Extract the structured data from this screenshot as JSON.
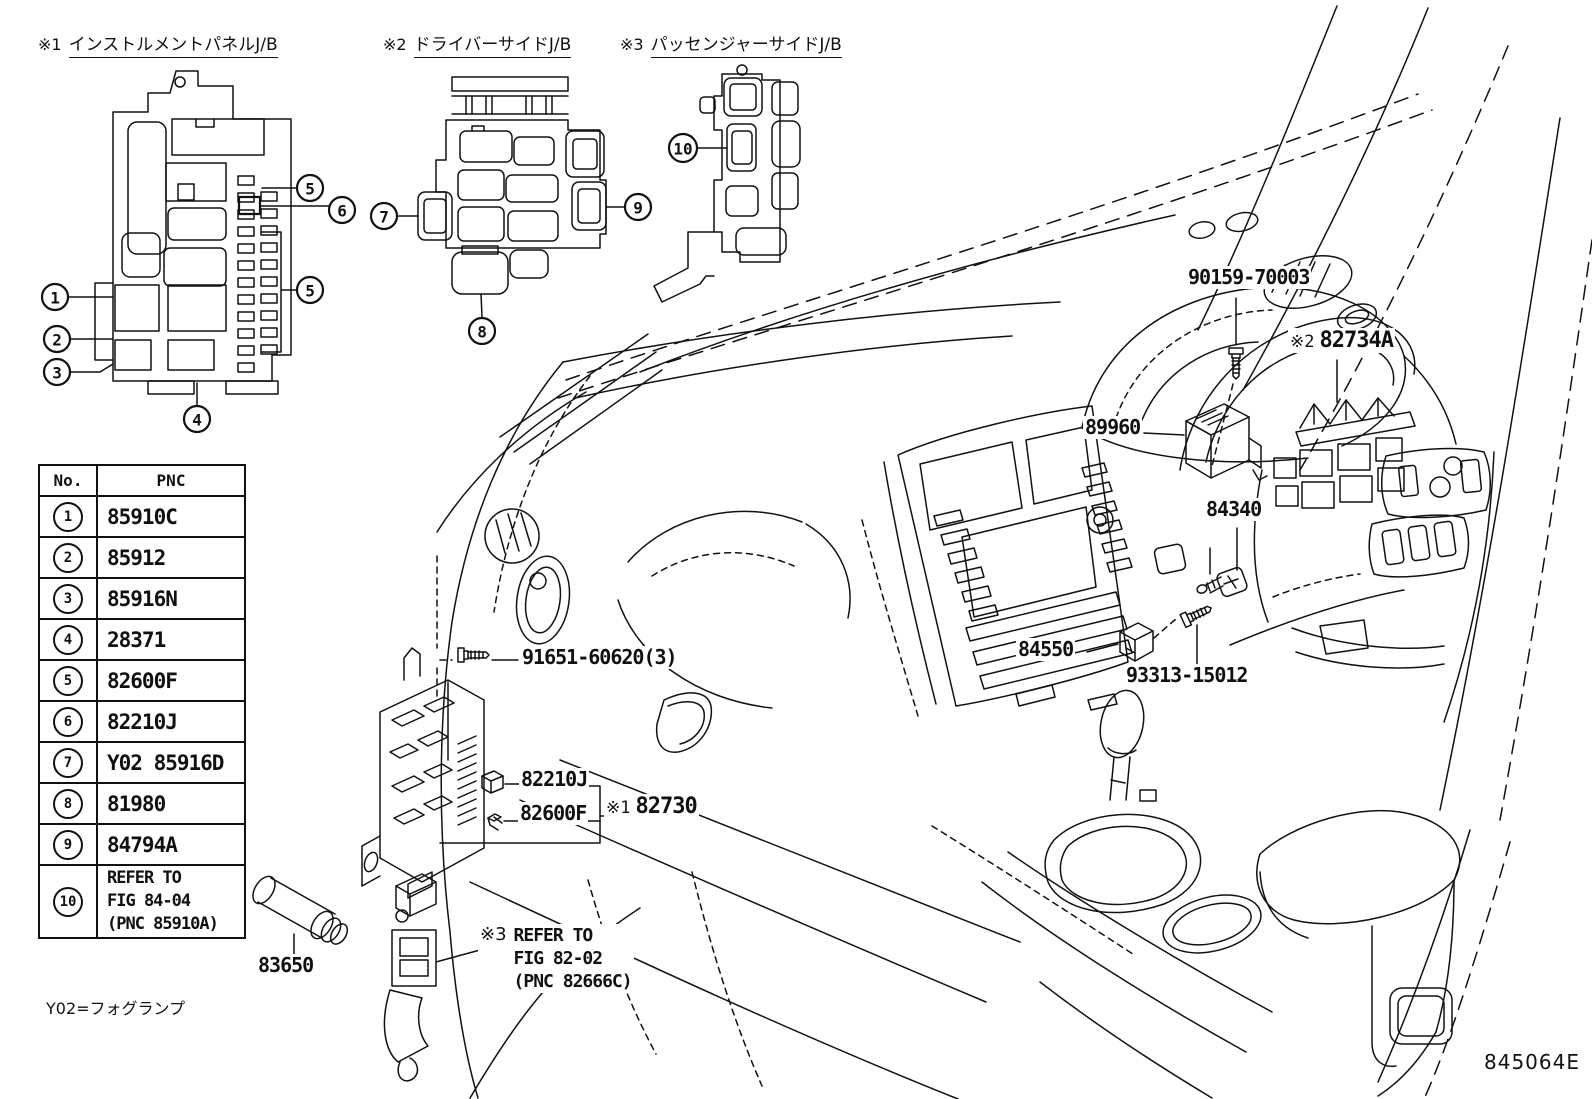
{
  "headers": [
    {
      "prefix": "※1",
      "label": "インストルメントパネルJ/B"
    },
    {
      "prefix": "※2",
      "label": "ドライバーサイドJ/B"
    },
    {
      "prefix": "※3",
      "label": "パッセンジャーサイドJ/B"
    }
  ],
  "table": {
    "col_no": "No.",
    "col_pnc": "PNC",
    "rows": [
      {
        "no": "1",
        "pnc": "85910C"
      },
      {
        "no": "2",
        "pnc": "85912"
      },
      {
        "no": "3",
        "pnc": "85916N"
      },
      {
        "no": "4",
        "pnc": "28371"
      },
      {
        "no": "5",
        "pnc": "82600F"
      },
      {
        "no": "6",
        "pnc": "82210J"
      },
      {
        "no": "7",
        "pnc": "Y02 85916D"
      },
      {
        "no": "8",
        "pnc": "81980"
      },
      {
        "no": "9",
        "pnc": "84794A"
      },
      {
        "no": "10",
        "pnc": "REFER TO\nFIG 84-04\n(PNC 85910A)"
      }
    ]
  },
  "callouts": {
    "n1": "1",
    "n2": "2",
    "n3": "3",
    "n4": "4",
    "n5": "5",
    "n6": "6",
    "n7": "7",
    "n8": "8",
    "n9": "9",
    "n10": "10"
  },
  "labels": {
    "screw_windshield": "90159-70003",
    "jb_driver_prefix": "※2",
    "jb_driver": "82734A",
    "ecu": "89960",
    "stop_lamp_switch": "84340",
    "key_box": "84550",
    "screw_console": "93313-15012",
    "screw_jb": "91651-60620(3)",
    "relay": "82210J",
    "noise_filter": "82600F",
    "jb_instrument_prefix": "※1",
    "jb_instrument": "82730",
    "fog_lamp_resistor": "83650",
    "note_prefix": "※3",
    "note": "REFER TO\nFIG 82-02\n(PNC 82666C)"
  },
  "footnote": "Y02=フォグランプ",
  "figure_code": "845064E"
}
